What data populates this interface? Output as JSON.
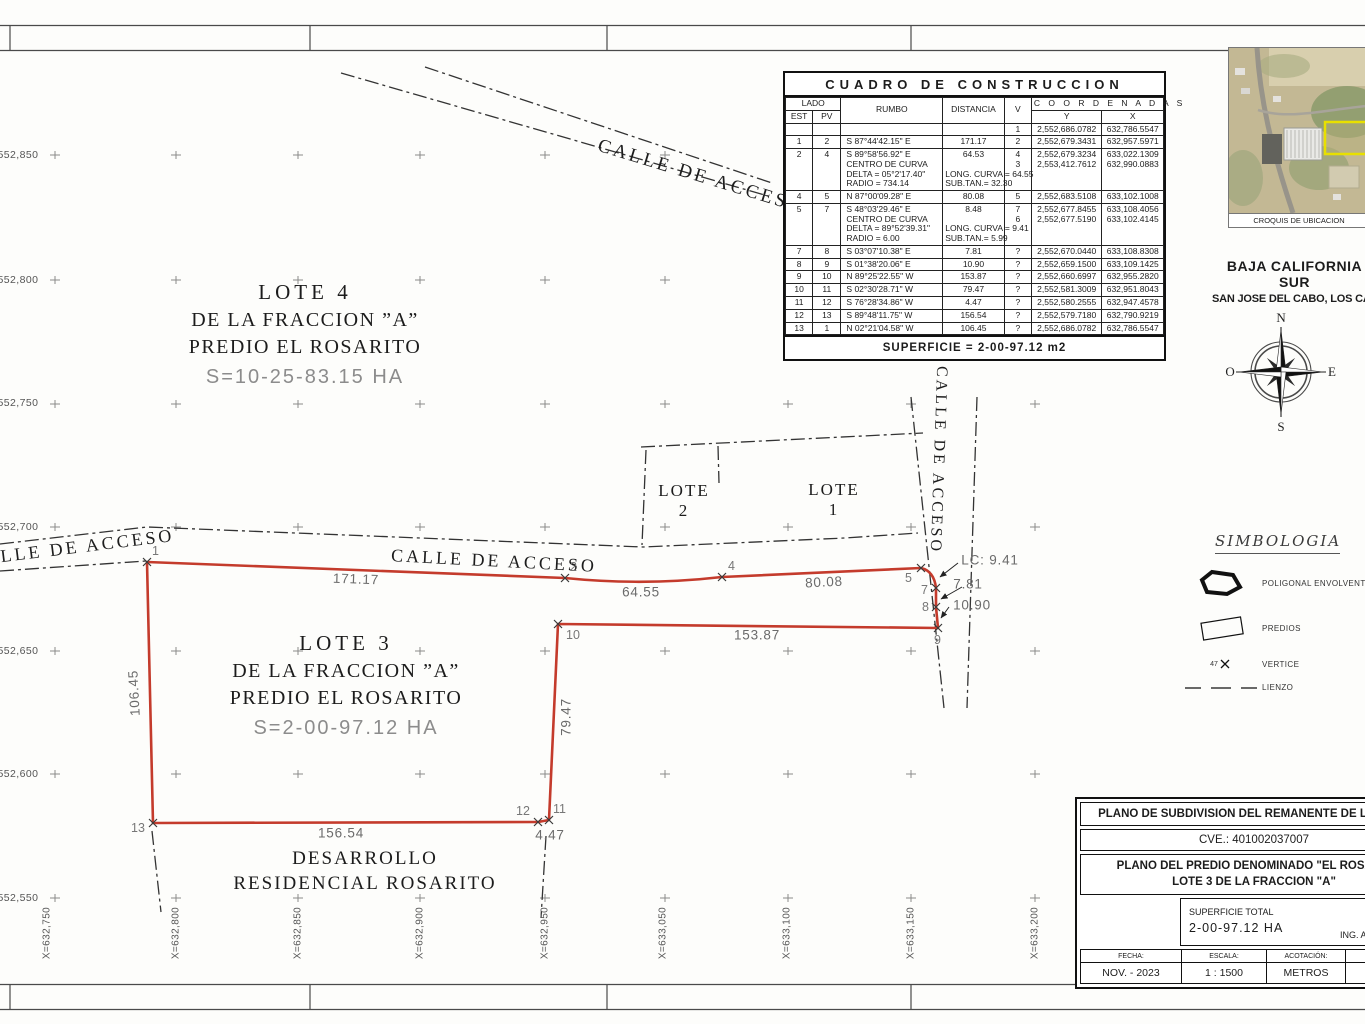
{
  "colors": {
    "polygon_red": "#c43b2c",
    "line_black": "#333333",
    "measure_gray": "#6b6b6b",
    "parcel_yellow": "#e8e000"
  },
  "grid": {
    "y_labels": [
      {
        "text": "2,552,850",
        "y": 155
      },
      {
        "text": "2,552,800",
        "y": 280
      },
      {
        "text": "2,552,750",
        "y": 403
      },
      {
        "text": "2,552,700",
        "y": 527
      },
      {
        "text": "2,552,650",
        "y": 651
      },
      {
        "text": "2,552,600",
        "y": 774
      },
      {
        "text": "2,552,550",
        "y": 898
      }
    ],
    "x_labels": [
      {
        "text": "X=632,750",
        "x": 47
      },
      {
        "text": "X=632,800",
        "x": 176
      },
      {
        "text": "X=632,850",
        "x": 298
      },
      {
        "text": "X=632,900",
        "x": 420
      },
      {
        "text": "X=632,950",
        "x": 545
      },
      {
        "text": "X=633,050",
        "x": 663
      },
      {
        "text": "X=633,100",
        "x": 787
      },
      {
        "text": "X=633,150",
        "x": 911
      },
      {
        "text": "X=633,200",
        "x": 1035
      }
    ]
  },
  "construction_table": {
    "title": "CUADRO DE CONSTRUCCION",
    "col_lado": "LADO",
    "col_est": "EST",
    "col_pv": "PV",
    "col_rumbo": "RUMBO",
    "col_distancia": "DISTANCIA",
    "col_v": "V",
    "col_coordenadas": "C O O R D E N A D A S",
    "col_y": "Y",
    "col_x": "X",
    "rows": [
      {
        "est": "",
        "pv": "",
        "rumbo": [],
        "dist": [],
        "v": [
          "1"
        ],
        "y": [
          "2,552,686.0782"
        ],
        "x": [
          "632,786.5547"
        ]
      },
      {
        "est": "1",
        "pv": "2",
        "rumbo": [
          "S 87°44'42.15\" E"
        ],
        "dist": [
          "171.17"
        ],
        "v": [
          "2"
        ],
        "y": [
          "2,552,679.3431"
        ],
        "x": [
          "632,957.5971"
        ]
      },
      {
        "est": "2",
        "pv": "4",
        "rumbo": [
          "S 89°58'56.92\" E",
          "CENTRO DE CURVA",
          "DELTA = 05°2'17.40\"",
          "RADIO = 734.14"
        ],
        "dist": [
          "64.53",
          "",
          "LONG. CURVA = 64.55",
          "SUB.TAN.= 32.30"
        ],
        "v": [
          "4",
          "3"
        ],
        "y": [
          "2,552,679.3234",
          "2,553,412.7612"
        ],
        "x": [
          "633,022.1309",
          "632,990.0883"
        ]
      },
      {
        "est": "4",
        "pv": "5",
        "rumbo": [
          "N 87°00'09.28\" E"
        ],
        "dist": [
          "80.08"
        ],
        "v": [
          "5"
        ],
        "y": [
          "2,552,683.5108"
        ],
        "x": [
          "633,102.1008"
        ]
      },
      {
        "est": "5",
        "pv": "7",
        "rumbo": [
          "S 48°03'29.46\" E",
          "CENTRO DE CURVA",
          "DELTA = 89°52'39.31\"",
          "RADIO = 6.00"
        ],
        "dist": [
          "8.48",
          "",
          "LONG. CURVA = 9.41",
          "SUB.TAN.= 5.99"
        ],
        "v": [
          "7",
          "6"
        ],
        "y": [
          "2,552,677.8455",
          "2,552,677.5190"
        ],
        "x": [
          "633,108.4056",
          "633,102.4145"
        ]
      },
      {
        "est": "7",
        "pv": "8",
        "rumbo": [
          "S 03°07'10.38\" E"
        ],
        "dist": [
          "7.81"
        ],
        "v": [
          "?"
        ],
        "y": [
          "2,552,670.0440"
        ],
        "x": [
          "633,108.8308"
        ]
      },
      {
        "est": "8",
        "pv": "9",
        "rumbo": [
          "S 01°38'20.06\" E"
        ],
        "dist": [
          "10.90"
        ],
        "v": [
          "?"
        ],
        "y": [
          "2,552,659.1500"
        ],
        "x": [
          "633,109.1425"
        ]
      },
      {
        "est": "9",
        "pv": "10",
        "rumbo": [
          "N 89°25'22.55\" W"
        ],
        "dist": [
          "153.87"
        ],
        "v": [
          "?"
        ],
        "y": [
          "2,552,660.6997"
        ],
        "x": [
          "632,955.2820"
        ]
      },
      {
        "est": "10",
        "pv": "11",
        "rumbo": [
          "S 02°30'28.71\" W"
        ],
        "dist": [
          "79.47"
        ],
        "v": [
          "?"
        ],
        "y": [
          "2,552,581.3009"
        ],
        "x": [
          "632,951.8043"
        ]
      },
      {
        "est": "11",
        "pv": "12",
        "rumbo": [
          "S 76°28'34.86\" W"
        ],
        "dist": [
          "4.47"
        ],
        "v": [
          "?"
        ],
        "y": [
          "2,552,580.2555"
        ],
        "x": [
          "632,947.4578"
        ]
      },
      {
        "est": "12",
        "pv": "13",
        "rumbo": [
          "S 89°48'11.75\" W"
        ],
        "dist": [
          "156.54"
        ],
        "v": [
          "?"
        ],
        "y": [
          "2,552,579.7180"
        ],
        "x": [
          "632,790.9219"
        ]
      },
      {
        "est": "13",
        "pv": "1",
        "rumbo": [
          "N 02°21'04.58\" W"
        ],
        "dist": [
          "106.45"
        ],
        "v": [
          "?"
        ],
        "y": [
          "2,552,686.0782"
        ],
        "x": [
          "632,786.5547"
        ]
      }
    ],
    "footer": "SUPERFICIE = 2-00-97.12 m2"
  },
  "croquis": {
    "caption": "CROQUIS DE UBICACION"
  },
  "location": {
    "region": "BAJA CALIFORNIA SUR",
    "city": "SAN JOSE DEL CABO, LOS CABOS B.C.S."
  },
  "compass": {
    "n": "N",
    "s": "S",
    "e": "E",
    "o": "O"
  },
  "simbologia": {
    "title": "SIMBOLOGIA",
    "vertex_sample": "47",
    "items": [
      {
        "label": "POLIGONAL ENVOLVENTE"
      },
      {
        "label": "PREDIOS"
      },
      {
        "label": "VERTICE"
      },
      {
        "label": "LIENZO"
      }
    ]
  },
  "drawing": {
    "street_labels": [
      {
        "text": "CALLE DE ACCESO",
        "x": 701,
        "y": 177,
        "rot": 17,
        "size": 19
      },
      {
        "text": "CALLE DE ACCESO",
        "x": 72,
        "y": 548,
        "rot": -7,
        "size": 18
      },
      {
        "text": "CALLE DE ACCESO",
        "x": 494,
        "y": 561,
        "rot": 3,
        "size": 18
      },
      {
        "text": "CALLE DE ACCESO",
        "x": 938,
        "y": 460,
        "rot": 92,
        "size": 16
      }
    ],
    "measurements": [
      {
        "text": "171.17",
        "x": 356,
        "y": 579,
        "rot": 2
      },
      {
        "text": "64.55",
        "x": 641,
        "y": 592,
        "rot": 0
      },
      {
        "text": "80.08",
        "x": 824,
        "y": 582,
        "rot": -3
      },
      {
        "text": "LC:  9.41",
        "x": 990,
        "y": 560,
        "rot": 0
      },
      {
        "text": "7.81",
        "x": 968,
        "y": 584,
        "rot": 0
      },
      {
        "text": "10.90",
        "x": 972,
        "y": 605,
        "rot": 0
      },
      {
        "text": "153.87",
        "x": 757,
        "y": 635,
        "rot": 0
      },
      {
        "text": "79.47",
        "x": 566,
        "y": 717,
        "rot": -90
      },
      {
        "text": "106.45",
        "x": 134,
        "y": 693,
        "rot": -93
      },
      {
        "text": "156.54",
        "x": 341,
        "y": 833,
        "rot": 0
      },
      {
        "text": "4.47",
        "x": 550,
        "y": 835,
        "rot": 0
      }
    ],
    "vertices": [
      {
        "n": "1",
        "x": 147,
        "y": 562,
        "lx": 152,
        "ly": 544
      },
      {
        "n": "2",
        "x": 565,
        "y": 578,
        "lx": 570,
        "ly": 560
      },
      {
        "n": "4",
        "x": 722,
        "y": 577,
        "lx": 728,
        "ly": 559
      },
      {
        "n": "5",
        "x": 921,
        "y": 568,
        "lx": 905,
        "ly": 571
      },
      {
        "n": "7",
        "x": 936,
        "y": 588,
        "lx": 921,
        "ly": 583
      },
      {
        "n": "8",
        "x": 936,
        "y": 607,
        "lx": 922,
        "ly": 600
      },
      {
        "n": "9",
        "x": 938,
        "y": 628,
        "lx": 934,
        "ly": 633
      },
      {
        "n": "10",
        "x": 558,
        "y": 624,
        "lx": 566,
        "ly": 628
      },
      {
        "n": "11",
        "x": 549,
        "y": 820,
        "lx": 553,
        "ly": 802
      },
      {
        "n": "12",
        "x": 538,
        "y": 822,
        "lx": 516,
        "ly": 804
      },
      {
        "n": "13",
        "x": 153,
        "y": 823,
        "lx": 131,
        "ly": 821
      }
    ],
    "lote4": {
      "title": "LOTE 4",
      "line2": "DE LA FRACCION ”A”",
      "line3": "PREDIO EL ROSARITO",
      "area": "S=10-25-83.15 HA"
    },
    "lote3": {
      "title": "LOTE 3",
      "line2": "DE LA FRACCION ”A”",
      "line3": "PREDIO EL ROSARITO",
      "area": "S=2-00-97.12 HA"
    },
    "lote2": {
      "name": "LOTE",
      "number": "2"
    },
    "lote1": {
      "name": "LOTE",
      "number": "1"
    },
    "desarrollo": {
      "line1": "DESARROLLO",
      "line2": "RESIDENCIAL ROSARITO"
    }
  },
  "title_block": {
    "row1": "PLANO DE SUBDIVISION DEL REMANENTE DE LA FRAC",
    "row2": "CVE.: 401002037007",
    "row3a": "PLANO DEL PREDIO DENOMINADO \"EL ROSARIT",
    "row3b": "LOTE 3 DE LA FRACCION \"A\"",
    "superficie_label": "SUPERFICIE TOTAL",
    "superficie_value": "2-00-97.12  HA",
    "dibujo_label": "DIBUJÓ",
    "dibujo_value": "ING. AURELIO ACC",
    "fecha_label": "FECHA:",
    "fecha_value": "NOV. - 2023",
    "escala_label": "ESCALA:",
    "escala_value": "1 : 1500",
    "acotacion_label": "ACOTACIÓN:",
    "acotacion_value": "METROS",
    "numero_label": "NUMER",
    "numero_value": "AHR:"
  }
}
